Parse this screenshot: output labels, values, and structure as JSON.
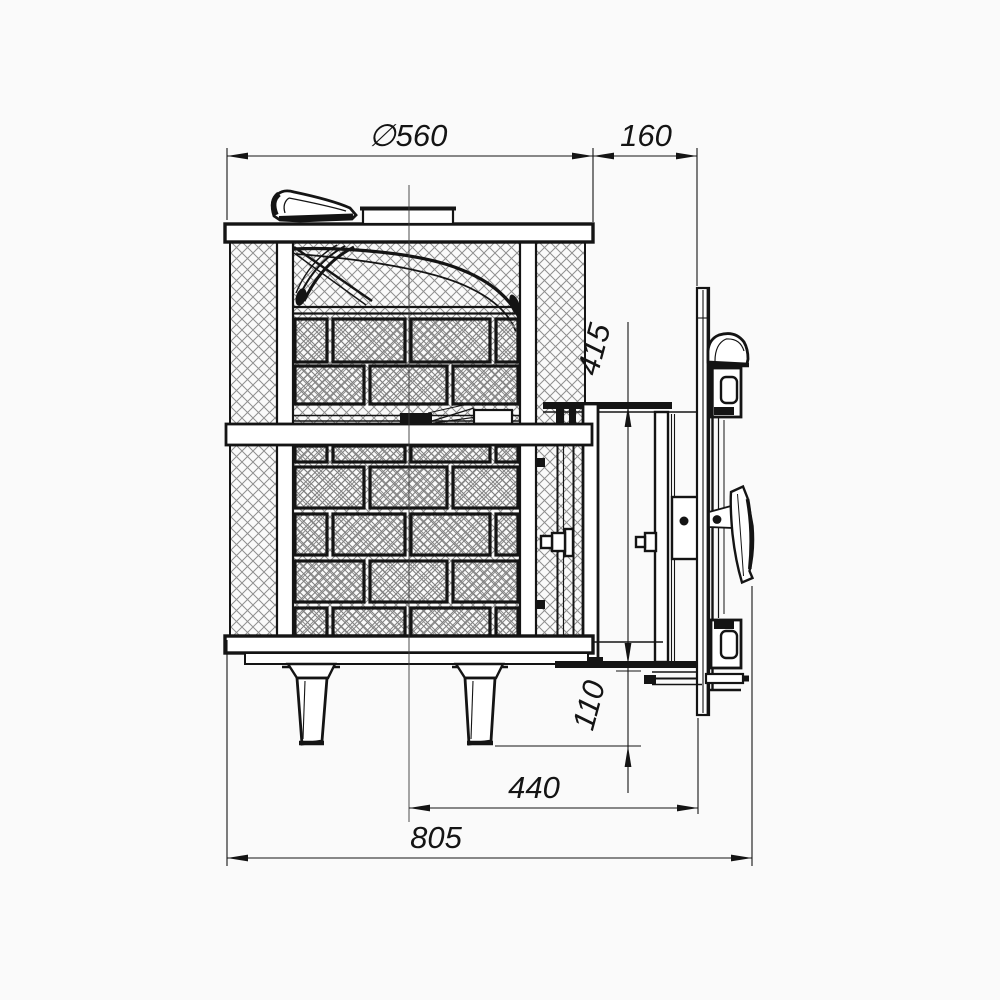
{
  "drawing": {
    "background": "#fafafa",
    "line_color": "#141414",
    "hatch_outer_color": "#8f8f8f",
    "hatch_brick_color": "#7f7f7f",
    "dims": {
      "d560": "∅560",
      "d160": "160",
      "d415": "415",
      "d110": "110",
      "d440": "440",
      "d805": "805"
    }
  }
}
